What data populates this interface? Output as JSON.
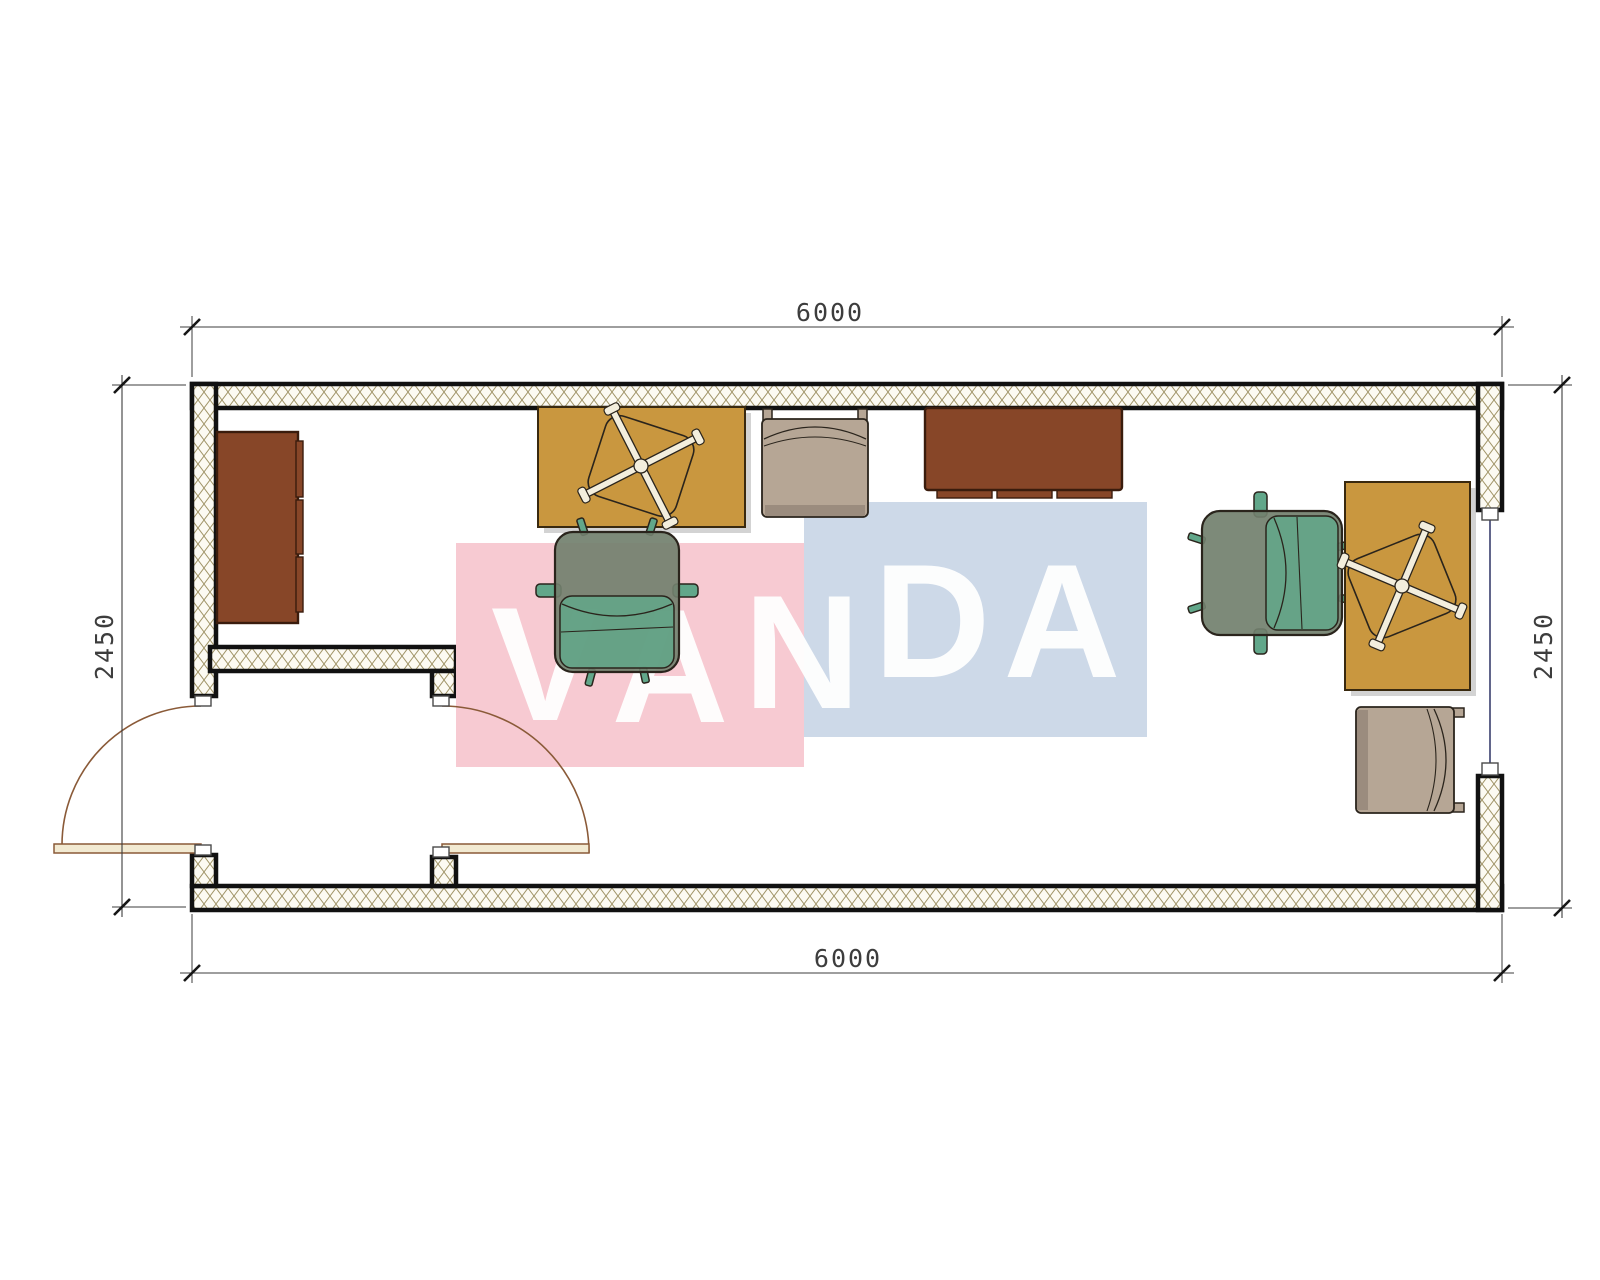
{
  "drawing": {
    "type": "architectural-floor-plan",
    "dimensions": {
      "top": "6000",
      "bottom": "6000",
      "left": "2450",
      "right": "2450"
    },
    "watermark": {
      "text": "VANDA",
      "letters": [
        "V",
        "A",
        "N",
        "D",
        "A"
      ]
    },
    "furniture": [
      "wardrobe-cabinet",
      "desk-top",
      "swivel-chair-base-top",
      "office-chair-middle",
      "guest-chair-top",
      "credenza",
      "office-chair-right",
      "desk-right",
      "swivel-chair-base-right",
      "guest-chair-right"
    ],
    "openings": [
      "entry-door-left",
      "entry-door-inner",
      "window-right"
    ],
    "colors": {
      "wall-line": "#111111",
      "hatch-line": "#a09467",
      "hatch-bg": "#fcfaf2",
      "brown": "#874628",
      "brown-dark": "#3a1c0d",
      "mustard": "#c9973f",
      "mustard-dark": "#39290f",
      "beige": "#b6a695",
      "beige-shade": "#9b8c7e",
      "chair-back": "#72806e",
      "chair-seat": "#62a78a",
      "ink": "#2a241c",
      "dim": "#3d3d3d",
      "door": "#8a5a38",
      "door-leaf": "#f2ead2",
      "window-glass": "#3a3f6e",
      "shadow": "#a8a8a8",
      "pink": "#f7cad2",
      "blue": "#cdd9e8",
      "letter": "#ffffff",
      "bone": "#f3eedd"
    }
  }
}
